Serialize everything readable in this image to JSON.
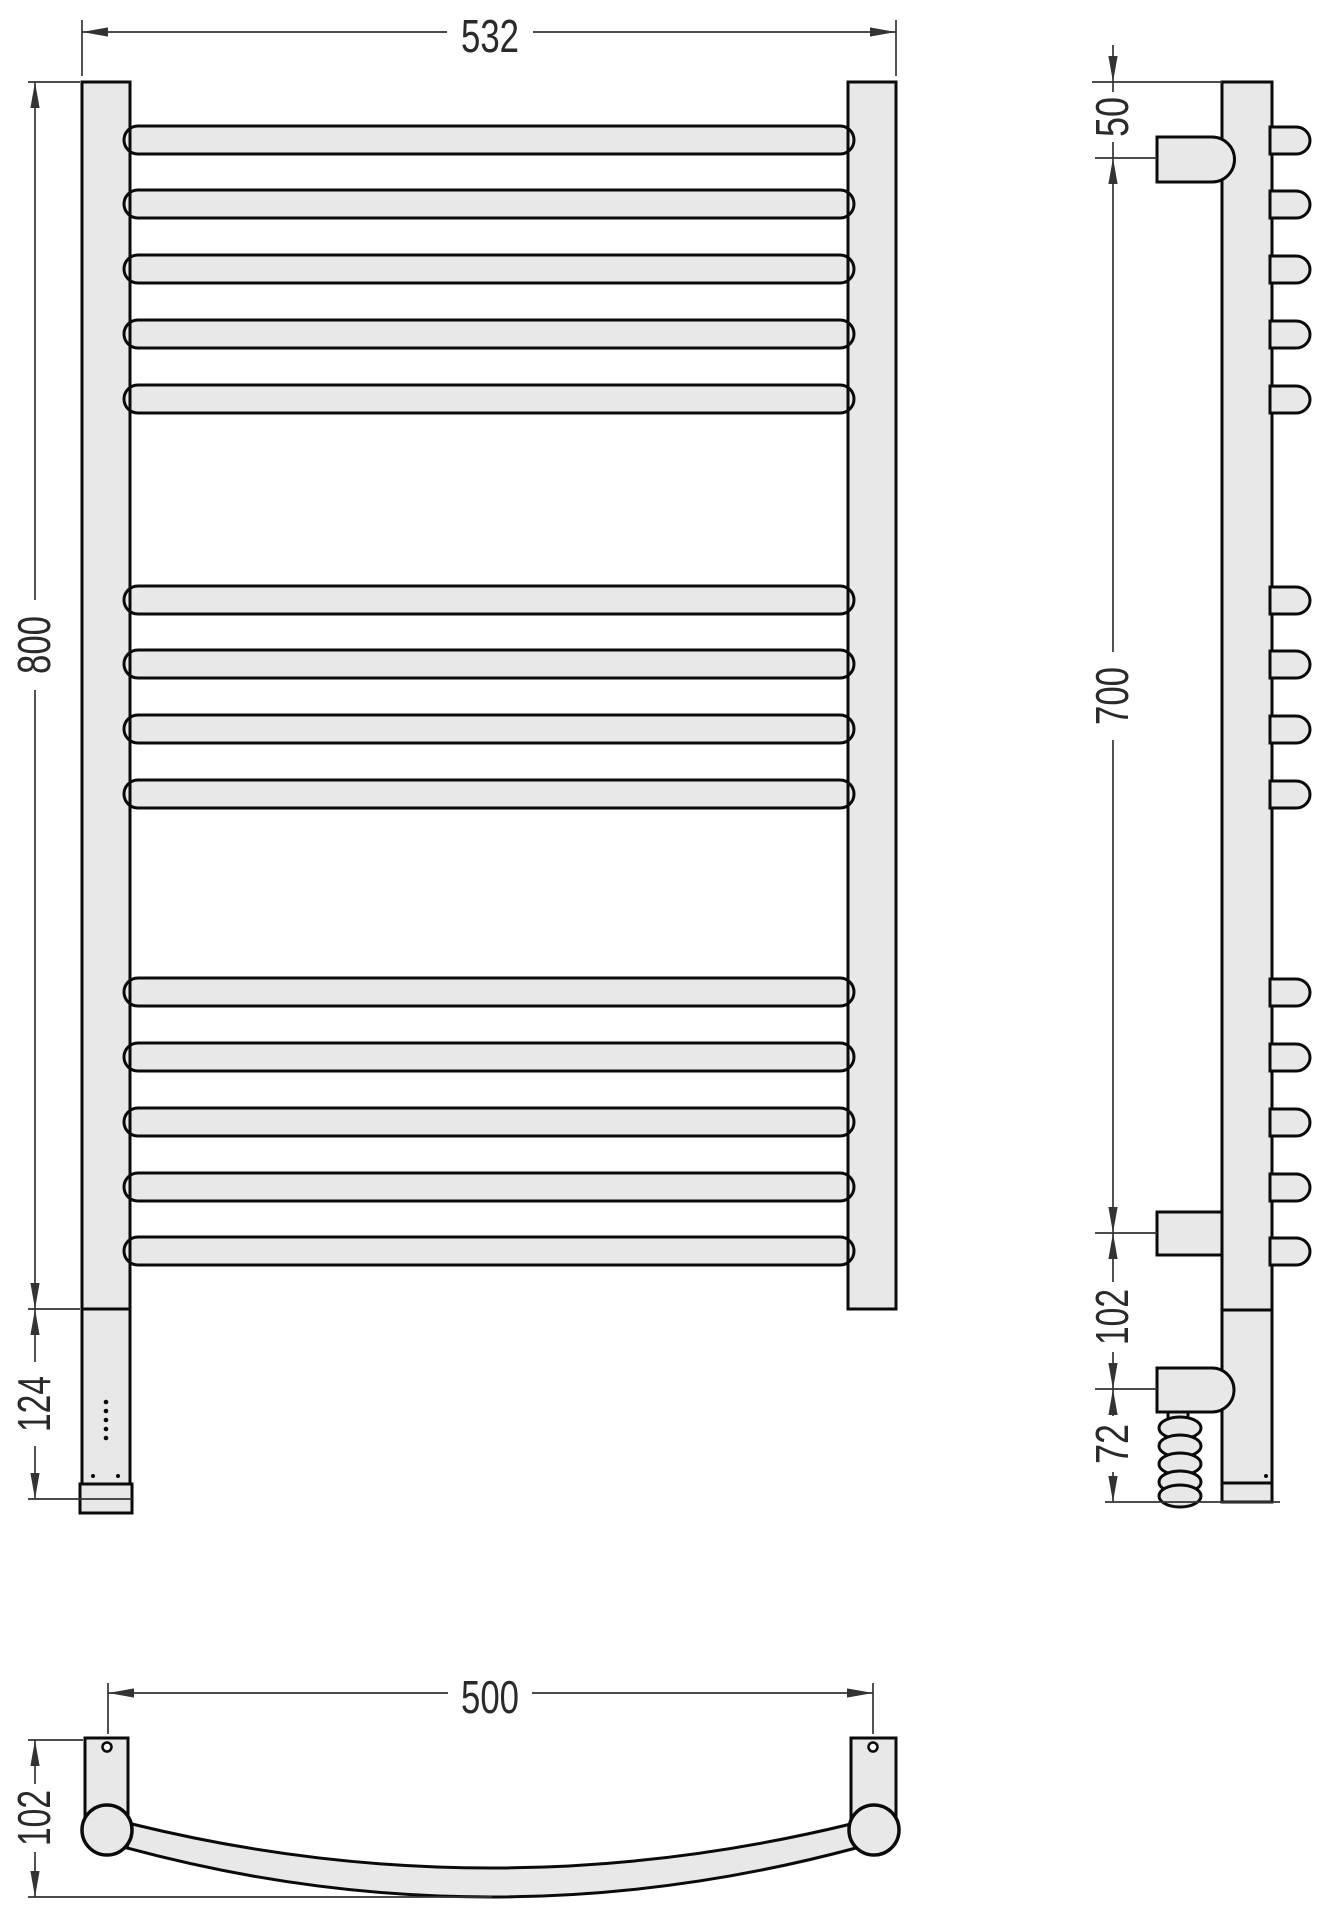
{
  "drawing": {
    "kind": "ladder-towel-rail-dimension-drawing",
    "views": [
      "front",
      "side",
      "top"
    ]
  },
  "front_view": {
    "width_label": "532",
    "height_label": "800",
    "lower_extension_label": "124",
    "rung_count": 14,
    "rung_groups": [
      5,
      4,
      5
    ],
    "vent_dot_count": 5,
    "base_dot_count": 2
  },
  "side_view": {
    "top_offset_label": "50",
    "bracket_span_label": "700",
    "bracket_to_heater_label": "102",
    "heater_to_bottom_label": "72",
    "stub_count": 14
  },
  "top_view": {
    "mount_span_label": "500",
    "depth_label": "102"
  },
  "colors": {
    "fill": "#e8e8e8",
    "outline": "#0a0a0a",
    "dimension_line": "#333333",
    "text": "#2a2a2a",
    "background": "#ffffff"
  }
}
